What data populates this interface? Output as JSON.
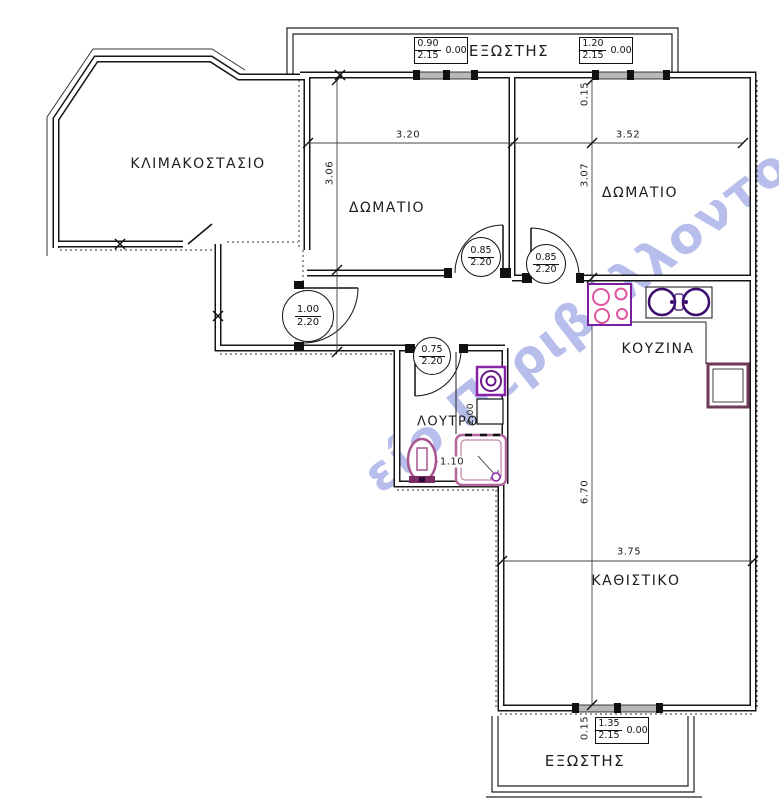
{
  "plan": {
    "watermark": "είο Περιβάλλοντος",
    "colors": {
      "wall": "#161616",
      "watermark_blue": "#7c88da",
      "fixture_purple": "#7b1fa2",
      "fixture_pink": "#e0559f",
      "fixture_dark_purple": "#3c0d6e",
      "fixture_mauve": "#a85590",
      "fridge_mauve": "#6d3a57",
      "shower_mauve": "#b06898"
    },
    "rooms": {
      "stairwell": {
        "label": "ΚΛΙΜΑΚΟΣΤΑΣΙΟ"
      },
      "bedroom1": {
        "label": "ΔΩΜΑΤΙΟ",
        "width": "3.20",
        "height": "3.06"
      },
      "bedroom2": {
        "label": "ΔΩΜΑΤΙΟ",
        "width": "3.52",
        "height": "3.07",
        "top_offset": "0.15"
      },
      "kitchen": {
        "label": "ΚΟΥΖΙΝΑ"
      },
      "bathroom": {
        "label": "ΛΟΥΤΡΟ",
        "shower_width": "1.10",
        "duct_depth": "2.00"
      },
      "living": {
        "label": "ΚΑΘΙΣΤΙΚΟ",
        "width": "3.75",
        "height": "6.70",
        "bottom_offset": "0.15"
      },
      "hall": {
        "width": "1.10"
      },
      "balcony_top": {
        "label": "ΕΞΩΣΤΗΣ"
      },
      "balcony_bottom": {
        "label": "ΕΞΩΣΤΗΣ"
      }
    },
    "doors": {
      "entry": {
        "width": "1.00",
        "height": "2.20"
      },
      "bedroom1": {
        "width": "0.85",
        "height": "2.20"
      },
      "bedroom2": {
        "width": "0.85",
        "height": "2.20"
      },
      "bathroom": {
        "width": "0.75",
        "height": "2.20"
      }
    },
    "windows": {
      "top_left": {
        "width": "0.90",
        "height": "2.15",
        "sill": "0.00"
      },
      "top_right": {
        "width": "1.20",
        "height": "2.15",
        "sill": "0.00"
      },
      "bottom": {
        "width": "1.35",
        "height": "2.15",
        "sill": "0.00"
      }
    }
  }
}
